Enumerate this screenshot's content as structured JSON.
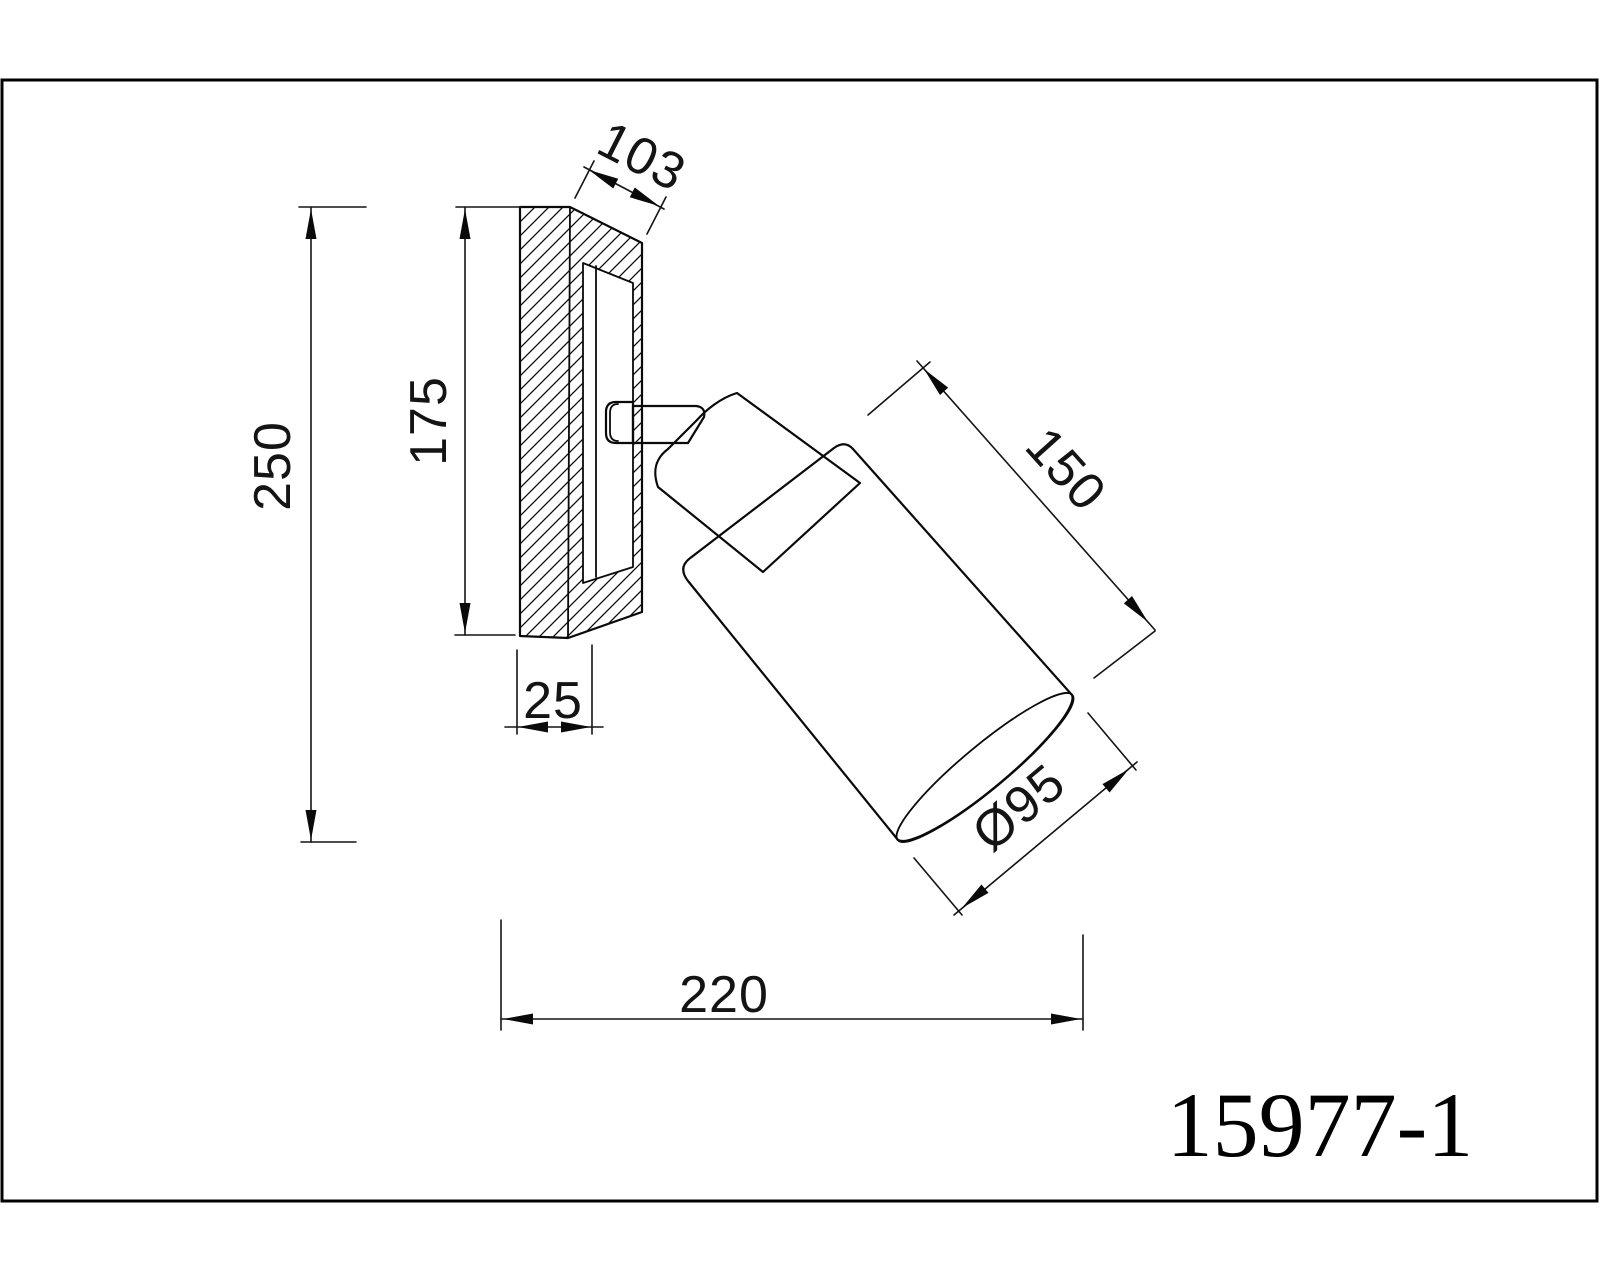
{
  "title_block": {
    "model_number": "15977-1"
  },
  "dimensions": {
    "plate_depth": {
      "label": "103"
    },
    "plate_height": {
      "label": "175"
    },
    "overall_height": {
      "label": "250"
    },
    "plate_thickness": {
      "label": "25"
    },
    "shade_length": {
      "label": "150"
    },
    "shade_diameter": {
      "label": "Ø95"
    },
    "overall_projection": {
      "label": "220"
    }
  },
  "colors": {
    "line": "#0a0a0a",
    "background": "#ffffff"
  },
  "drawing_type": "technical dimension drawing",
  "subject": "wall spot lamp side section view"
}
